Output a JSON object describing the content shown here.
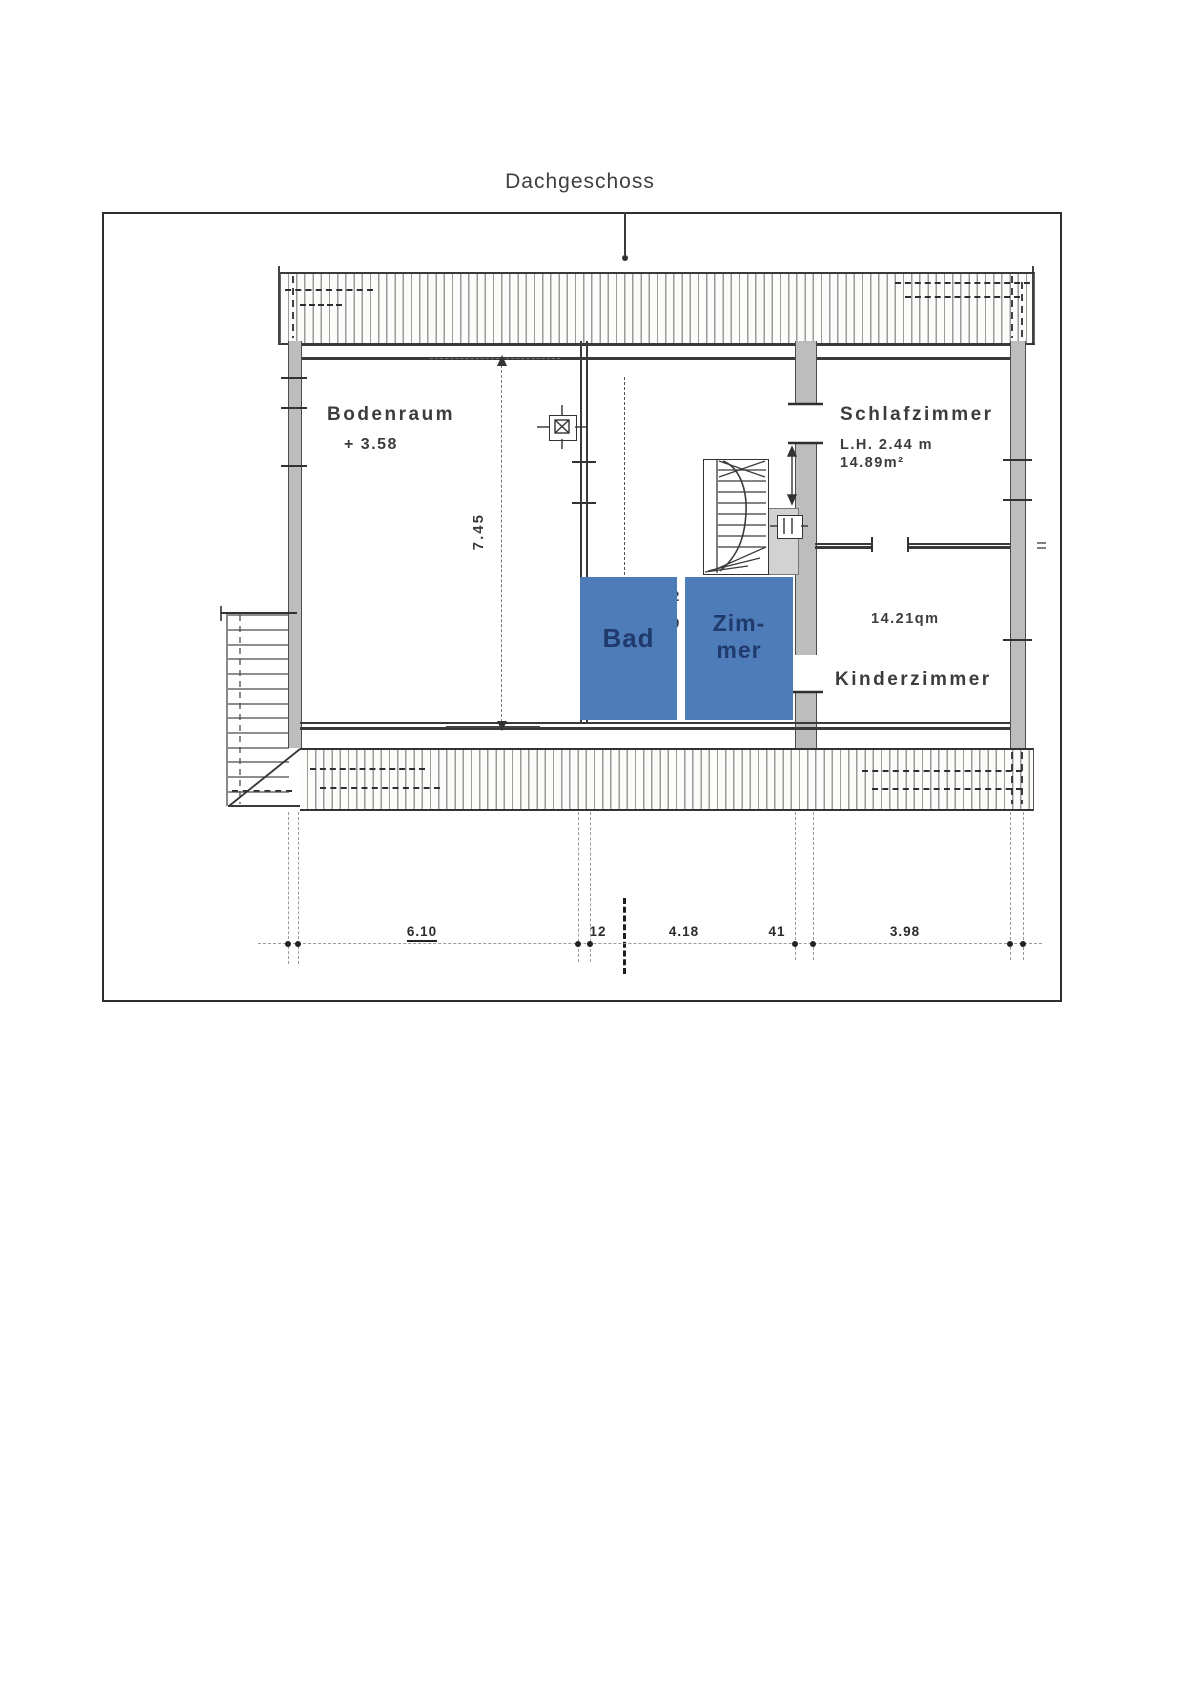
{
  "title": "Dachgeschoss",
  "rooms": {
    "bodenraum": {
      "label": "Bodenraum",
      "level": "+ 3.58"
    },
    "schlafzimmer": {
      "label": "Schlafzimmer",
      "clear_height": "L.H. 2.44 m",
      "area": "14.89m²"
    },
    "kinderzimmer": {
      "label": "Kinderzimmer",
      "area": "14.21qm"
    },
    "bad": {
      "label": "Bad"
    },
    "zimmer": {
      "label_line1": "Zim-",
      "label_line2": "mer"
    }
  },
  "partial_digits": {
    "top": "2",
    "bottom": "9"
  },
  "dimensions": {
    "vertical_span": "7.45",
    "bottom_row": [
      {
        "label": "6.10"
      },
      {
        "label": "12"
      },
      {
        "label": "4.18"
      },
      {
        "label": "41"
      },
      {
        "label": "3.98"
      }
    ]
  },
  "colors": {
    "overlay_blue": "#4d7cb8",
    "overlay_text": "#203a6e",
    "wall_gray": "#bdbdbd",
    "line_dark": "#333333",
    "paper": "#ffffff"
  }
}
